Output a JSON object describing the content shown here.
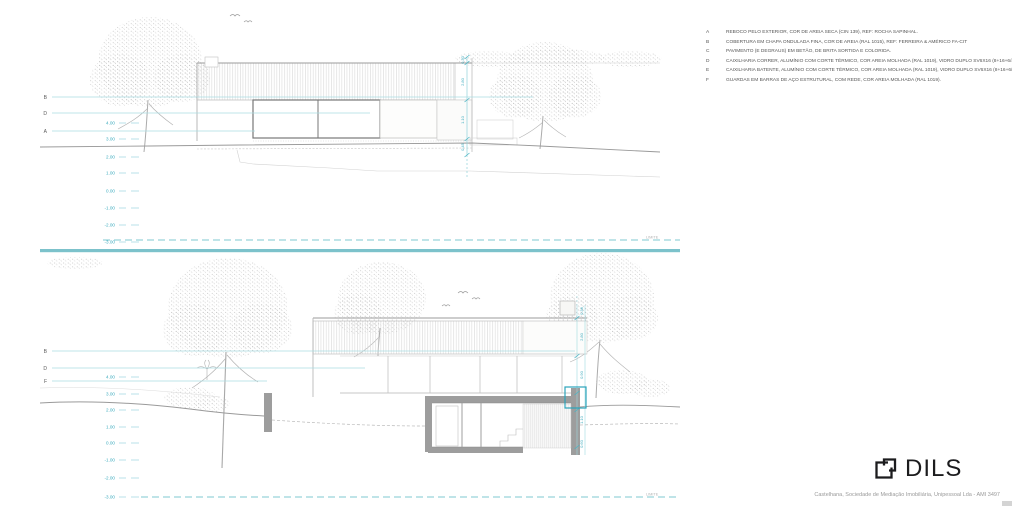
{
  "colors": {
    "accent_cyan": "#49b4c4",
    "divider_teal": "#7cc2cb",
    "section_gray": "#9d9d9d",
    "logo": "#1c1c1e"
  },
  "legend": {
    "items": [
      {
        "key": "A",
        "text": "REBOCO PELO EXTERIOR, COR DE AREIA SECA (CIN 139), REF: ROCHA SAPINHAL."
      },
      {
        "key": "B",
        "text": "COBERTURA EM CHAPA ONDULADA FINA, COR DE AREIA (RAL 1015), REF: FERREIRA & AMÉRICO FA-CIT"
      },
      {
        "key": "C",
        "text": "PAVIMENTO (E DEGRAUS) EM BETÃO, DE BRITA SORTIDA E COLORIDA."
      },
      {
        "key": "D",
        "text": "CAIXILHARIA CORRER, ALUMÍNIO COM CORTE TÉRMICO, COR AREIA MOLHADA (RAL 1019), VIDRO DUPLO SV6X16 (8+16+6/4.2), REF: SOSOARES, SISTEMA DE"
      },
      {
        "key": "E",
        "text": "CAIXILHARIA BATENTE, ALUMÍNIO COM CORTE TÉRMICO, COR AREIA MOLHADA (RAL 1019), VIDRO DUPLO SV6X16 (8+16+6/4.2), REF: REYNAERS, SLIMLINE 38 (CLASSIC/FERRO)"
      },
      {
        "key": "F",
        "text": "GUARDAS EM BARRAS DE AÇO ESTRUTURAL, COM REDE, COR AREIA MOLHADA (RAL 1019)."
      }
    ]
  },
  "top": {
    "leaders": [
      "B",
      "D",
      "A"
    ],
    "levels": [
      "4.00",
      "3.00",
      "2.00",
      "1.00",
      "0.00",
      "-1.00",
      "-2.00",
      "-3.00"
    ],
    "dims": [
      "0.30",
      "2.80",
      "1.10",
      "0.45"
    ],
    "boundary": "LIMITE"
  },
  "bottom": {
    "leaders": [
      "B",
      "D",
      "F"
    ],
    "levels": [
      "4.00",
      "3.00",
      "2.00",
      "1.00",
      "0.00",
      "-1.00",
      "-2.00",
      "-3.00"
    ],
    "dims": [
      "0.38",
      "2.80",
      "0.90",
      "1.10",
      "0.60"
    ],
    "boundary": "LIMITE"
  },
  "footer": {
    "brand": "DILS",
    "credit": "Castelhana, Sociedade de Mediação Imobiliária, Unipessoal Lda - AMI 3497"
  }
}
